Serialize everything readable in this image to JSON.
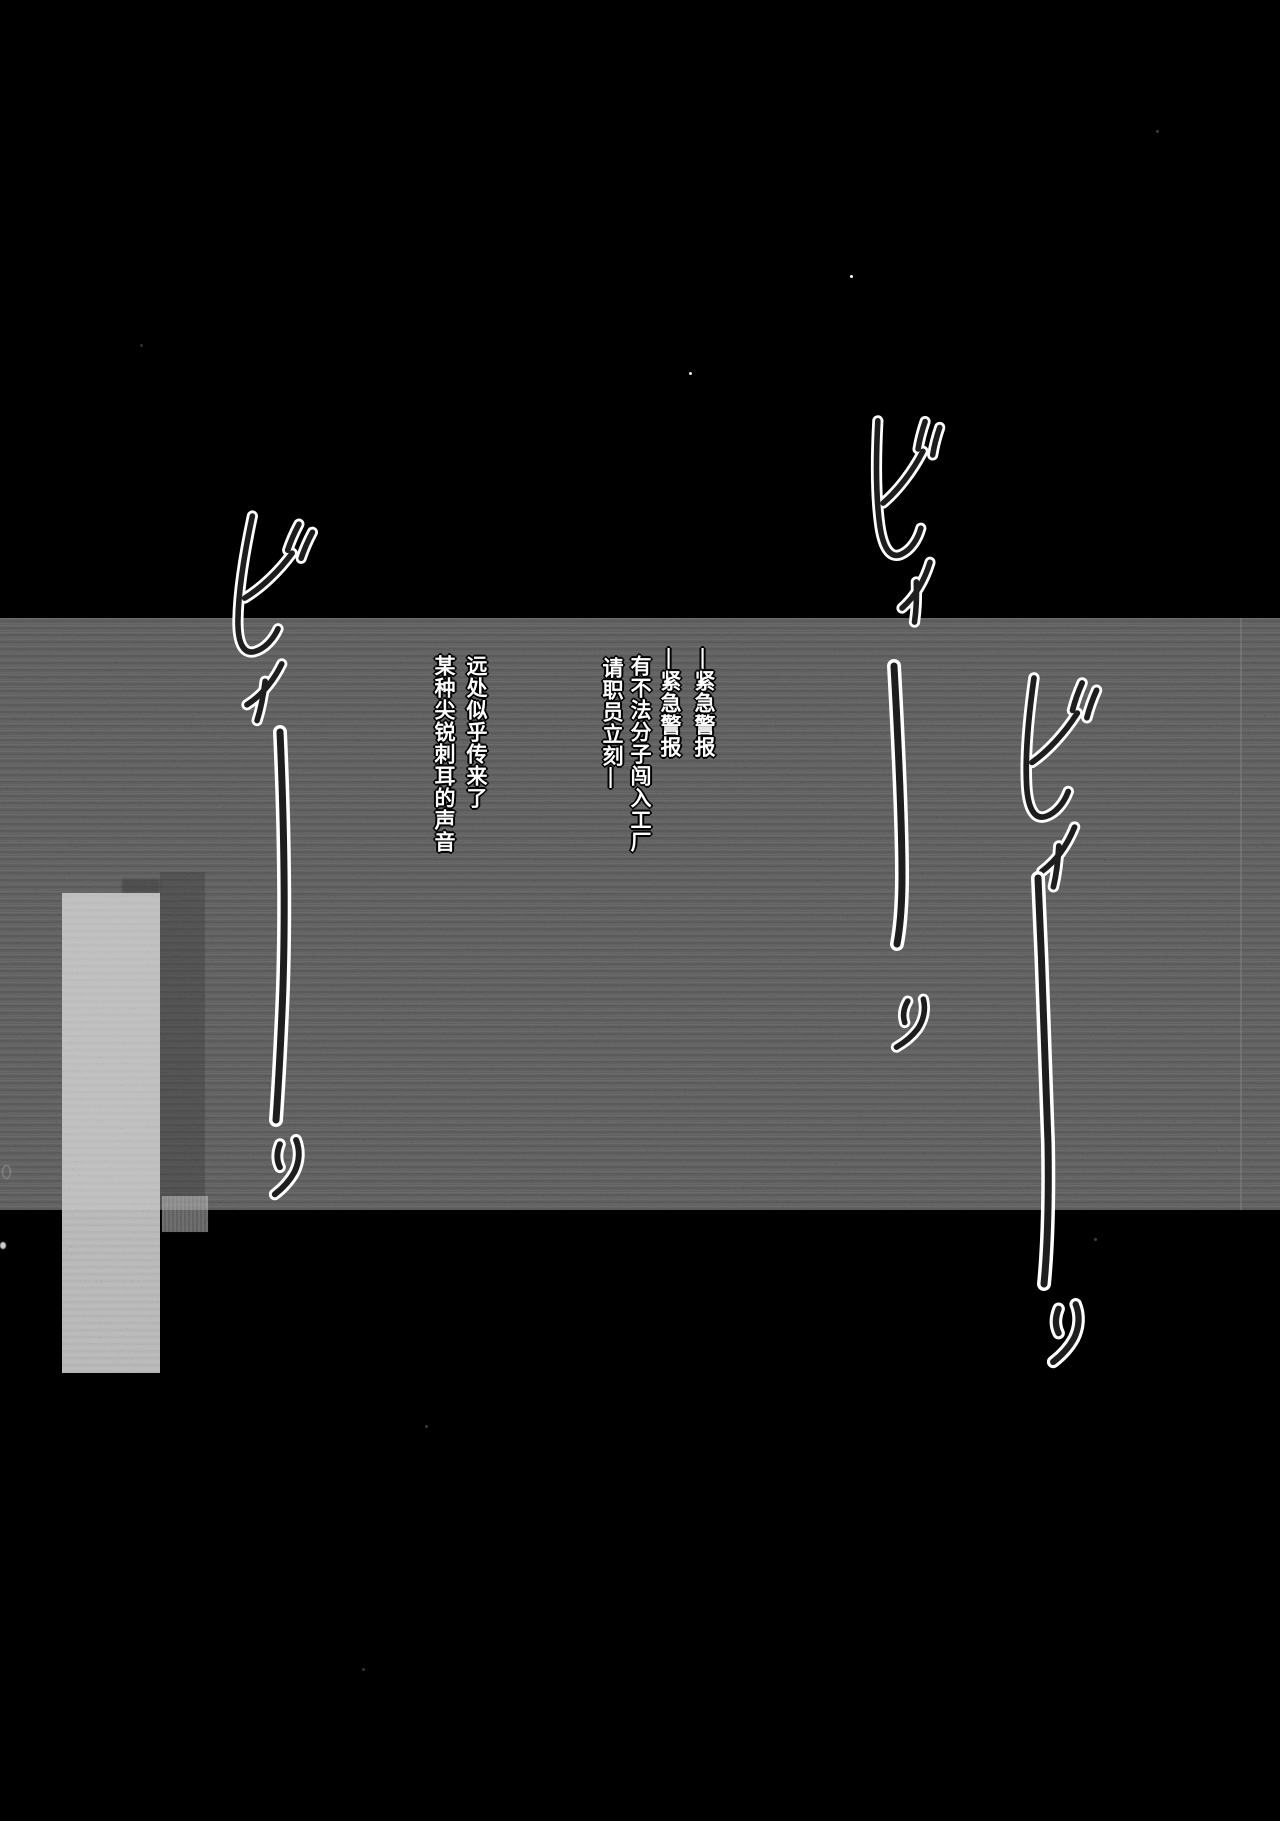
{
  "page": {
    "background_color": "#000000",
    "panel_band_color": "#353535",
    "highlight_block_color": "#7c7c7c",
    "text_color": "#ffffff",
    "outline_color": "#000000"
  },
  "dialogue": {
    "columns": [
      {
        "text": "—紧急警报"
      },
      {
        "text": "—紧急警报"
      },
      {
        "text": "有不法分子闯入工厂"
      },
      {
        "text": "请职员立刻—"
      },
      {
        "text": "远处似乎传来了"
      },
      {
        "text": "某种尖锐刺耳的声音"
      }
    ]
  },
  "sfx": [
    {
      "reading": "ビィーーッ",
      "position": "left"
    },
    {
      "reading": "ビィーーッ",
      "position": "upper-right"
    },
    {
      "reading": "ビィーーッ",
      "position": "right"
    }
  ]
}
